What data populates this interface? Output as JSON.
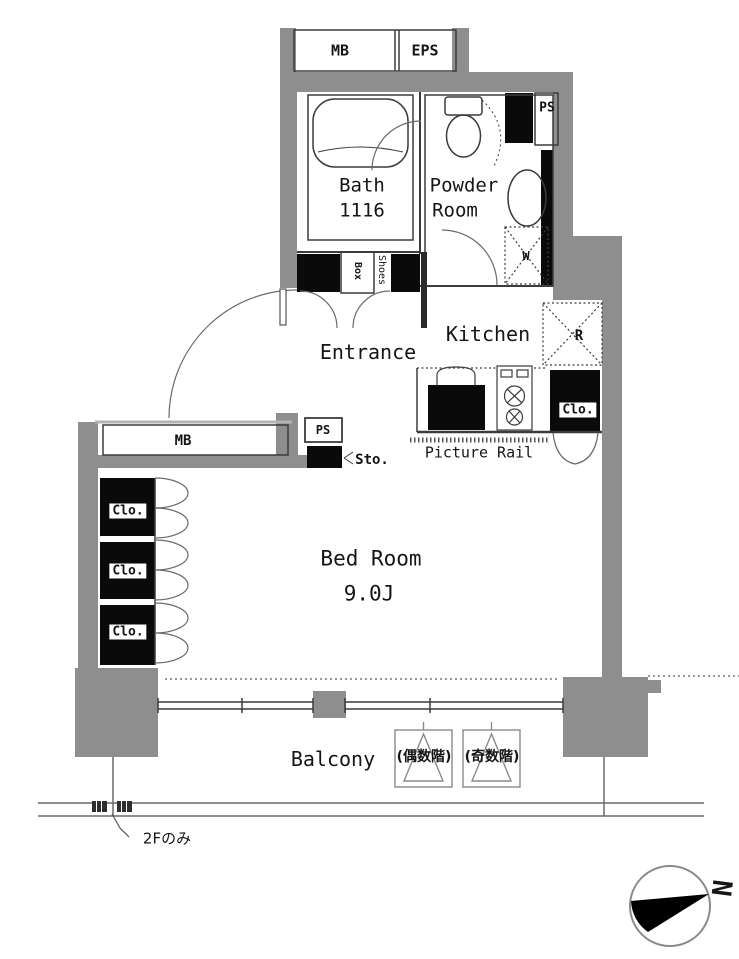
{
  "meta": {
    "kind": "apartment-floor-plan"
  },
  "colors": {
    "wall": "#8e8e8e",
    "fixture": "#0a0a0a",
    "line": "#3c3c3c"
  },
  "shafts": {
    "mb_top": "MB",
    "eps": "EPS",
    "ps_upper": "PS",
    "ps_lower": "PS",
    "mb_side": "MB",
    "storage": "Sto."
  },
  "rooms": {
    "bath": {
      "name": "Bath",
      "size": "1116"
    },
    "powder": {
      "line1": "Powder",
      "line2": "Room"
    },
    "kitchen": {
      "name": "Kitchen",
      "fridge": "R"
    },
    "entrance": {
      "name": "Entrance",
      "shoes_outer": "Shoes",
      "shoes_inner": "Box"
    },
    "bedroom": {
      "name": "Bed Room",
      "size": "9.0J"
    },
    "balcony": {
      "name": "Balcony"
    }
  },
  "closets": {
    "left": [
      "Clo.",
      "Clo.",
      "Clo."
    ],
    "kitchen": "Clo."
  },
  "fixtures": {
    "washer": "W"
  },
  "annotations": {
    "picture_rail": "Picture Rail",
    "hatch_even": "(偶数階)",
    "hatch_odd": "(奇数階)",
    "floor_note": "2Fのみ",
    "north": "N"
  }
}
